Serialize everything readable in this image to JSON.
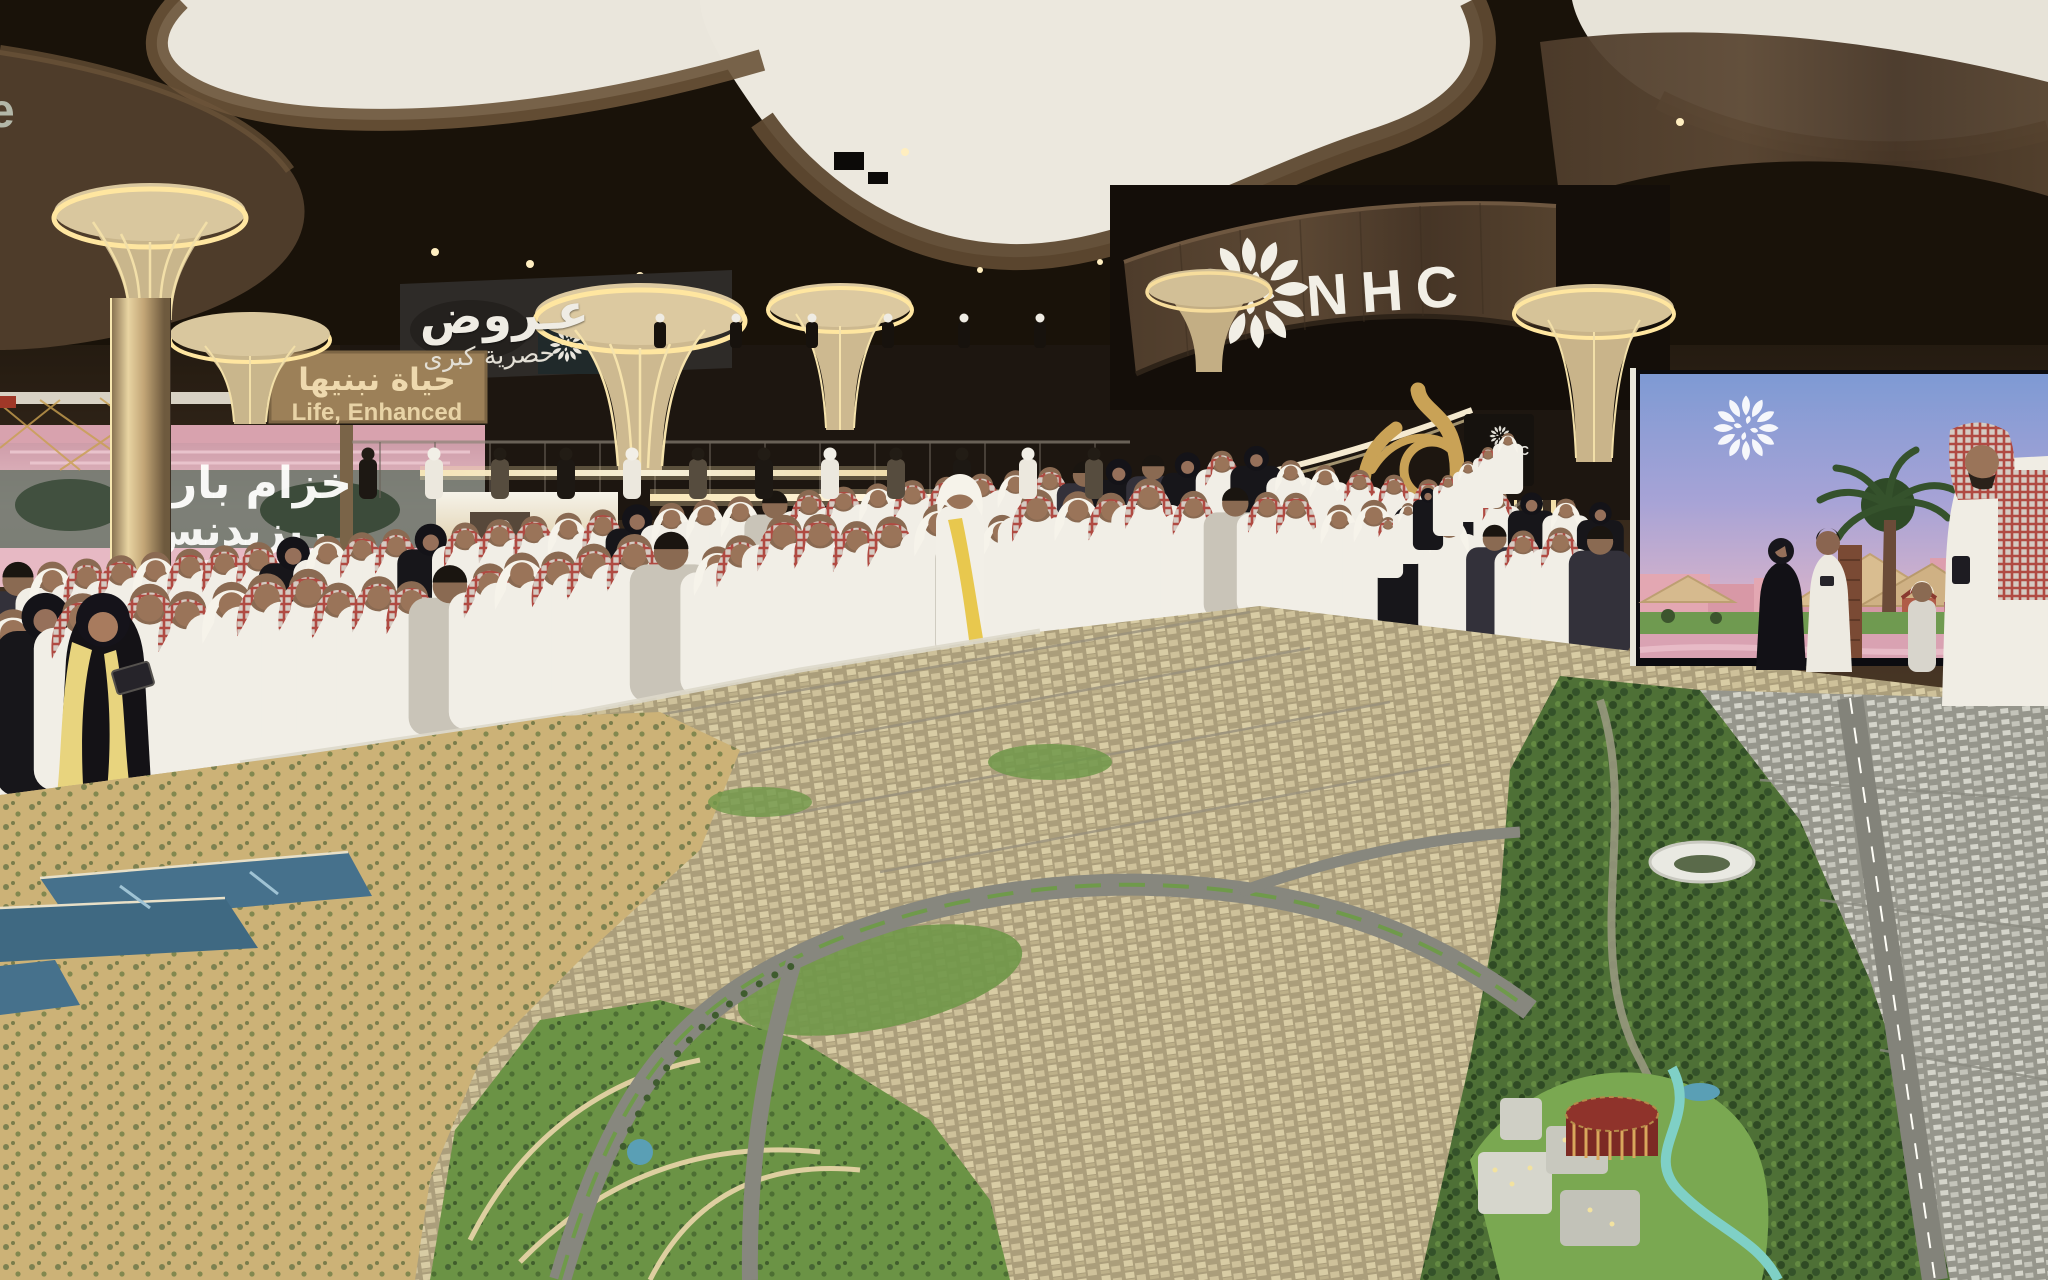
{
  "scene": {
    "title": "NHC exhibition stand with giant city masterplan scale model",
    "environment": "indoor exhibition hall, dense visitor crowd in Saudi traditional dress viewing the model"
  },
  "branding": {
    "wordmark": "NHC",
    "logo_icon": "nhc-floral-emblem",
    "edge_partial_letter": "e"
  },
  "signs": {
    "offers": {
      "line1": "عـروض",
      "line2": "حصرية كبرى"
    },
    "tagline": {
      "arabic": "حياة نبنيها",
      "english": "Life, Enhanced"
    },
    "khuzam_screen": {
      "line1": "خزام بارك",
      "line2": "ريزيدنس"
    },
    "park_screen": {
      "brand": "NHC"
    },
    "stair_screen": {
      "brand": "NHC"
    }
  },
  "palette": {
    "ceiling_panel": "#eae6dc",
    "wood_dark": "#4a392a",
    "wood_light": "#d9c69e",
    "gold_glow": "#ffe3a0",
    "thobe_white": "#f1eee6",
    "shemagh_red": "#b5645a",
    "abaya_black": "#17161a",
    "model_sand": "#ccb277",
    "model_green": "#6b9345",
    "model_water": "#46718c",
    "river_turquoise": "#7fd0c6",
    "screen_sky_blue": "#86a0d6",
    "screen_pink": "#e3a7b2",
    "landmark_red": "#8f332b"
  }
}
